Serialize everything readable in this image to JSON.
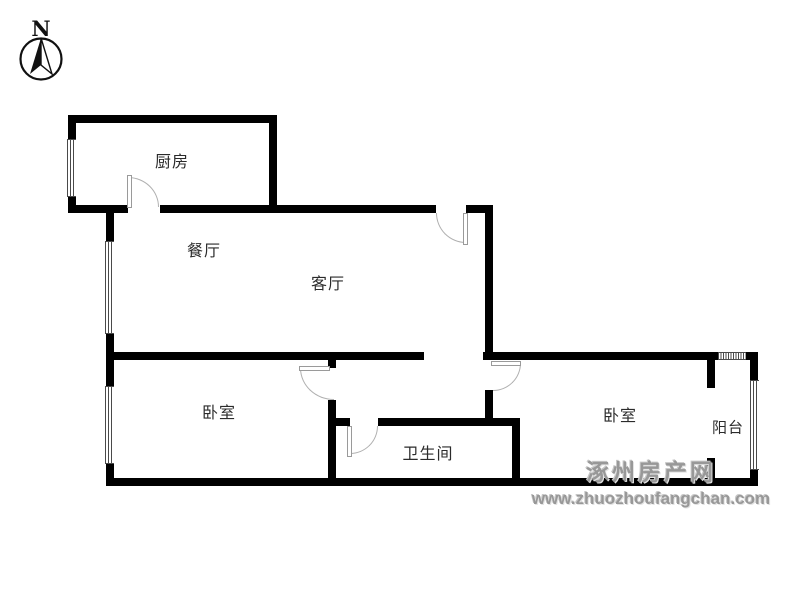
{
  "compass": {
    "north_label": "N"
  },
  "rooms": {
    "kitchen": {
      "label": "厨房"
    },
    "dining": {
      "label": "餐厅"
    },
    "living": {
      "label": "客厅"
    },
    "bedroom_left": {
      "label": "卧室"
    },
    "bedroom_right": {
      "label": "卧室"
    },
    "bathroom": {
      "label": "卫生间"
    },
    "balcony": {
      "label": "阳台"
    }
  },
  "watermark": {
    "site_name": "涿州房产网",
    "site_url": "www.zhuozhoufangchan.com"
  },
  "colors": {
    "wall": "#000000",
    "door_arc": "#b0b0b0",
    "label_text": "#2b2b2b",
    "watermark_gray": "#989898",
    "background": "#ffffff"
  }
}
